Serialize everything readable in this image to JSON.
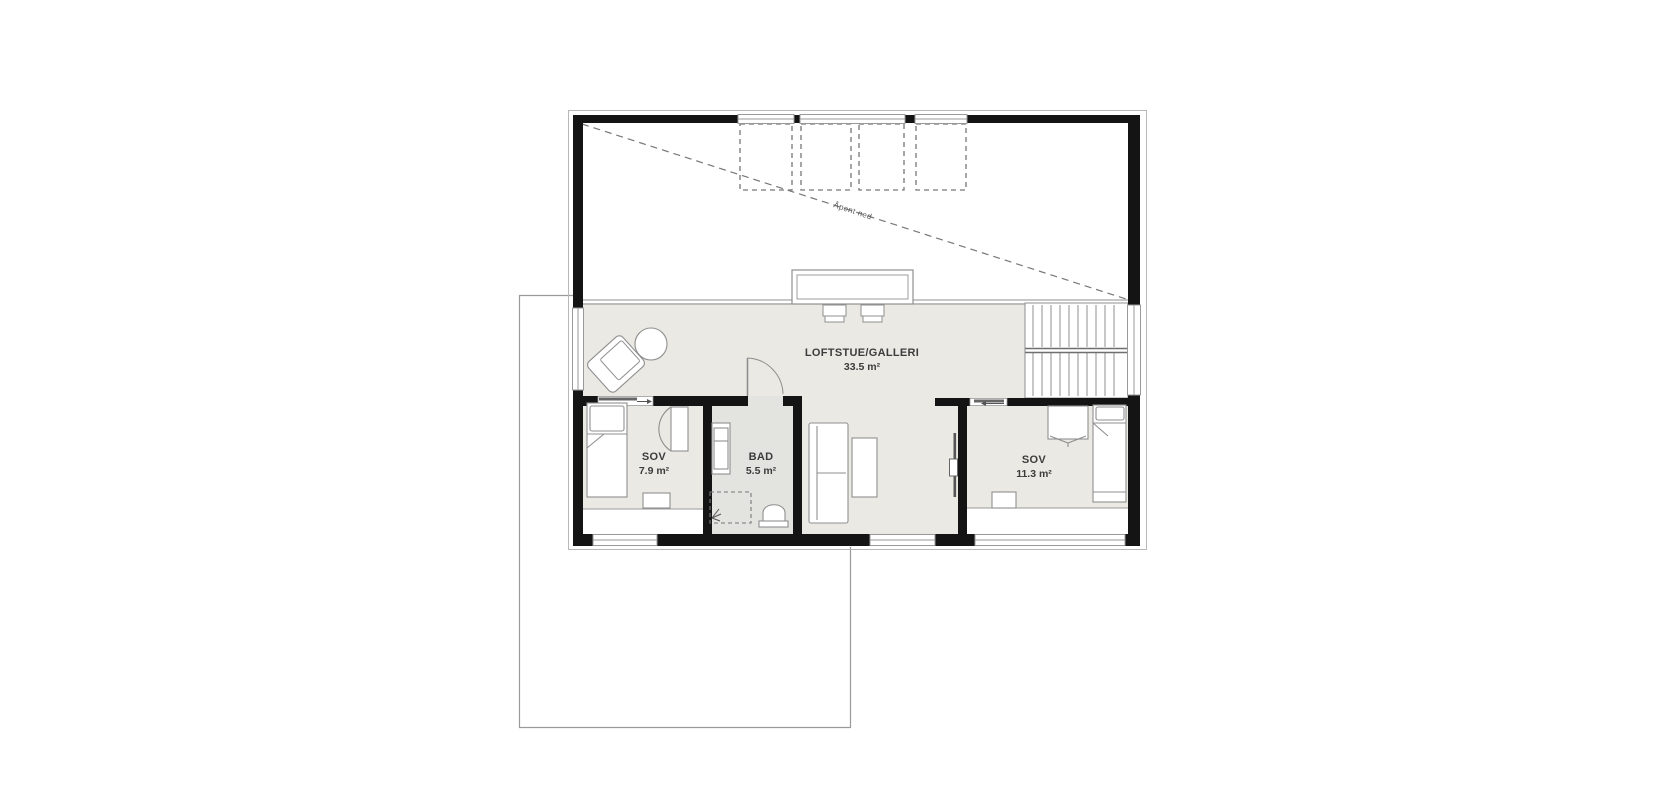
{
  "title": "Loft floor plan",
  "colors": {
    "background": "#ffffff",
    "floor": "#eae9e3",
    "floor_bathroom": "#e3e3df",
    "wall": "#141414",
    "furniture_stroke": "#8f8f8f",
    "window_stroke": "#999999",
    "dashed_line": "#777777",
    "outline": "#b0b0b0",
    "text": "#3c3c3c"
  },
  "rooms": {
    "loftstue": {
      "name": "LOFTSTUE/GALLERI",
      "area": "33.5 m²"
    },
    "sov_left": {
      "name": "SOV",
      "area": "7.9 m²"
    },
    "bad": {
      "name": "BAD",
      "area": "5.5 m²"
    },
    "sov_right": {
      "name": "SOV",
      "area": "11.3 m²"
    }
  },
  "annotations": {
    "open_below": "Åpent ned"
  }
}
